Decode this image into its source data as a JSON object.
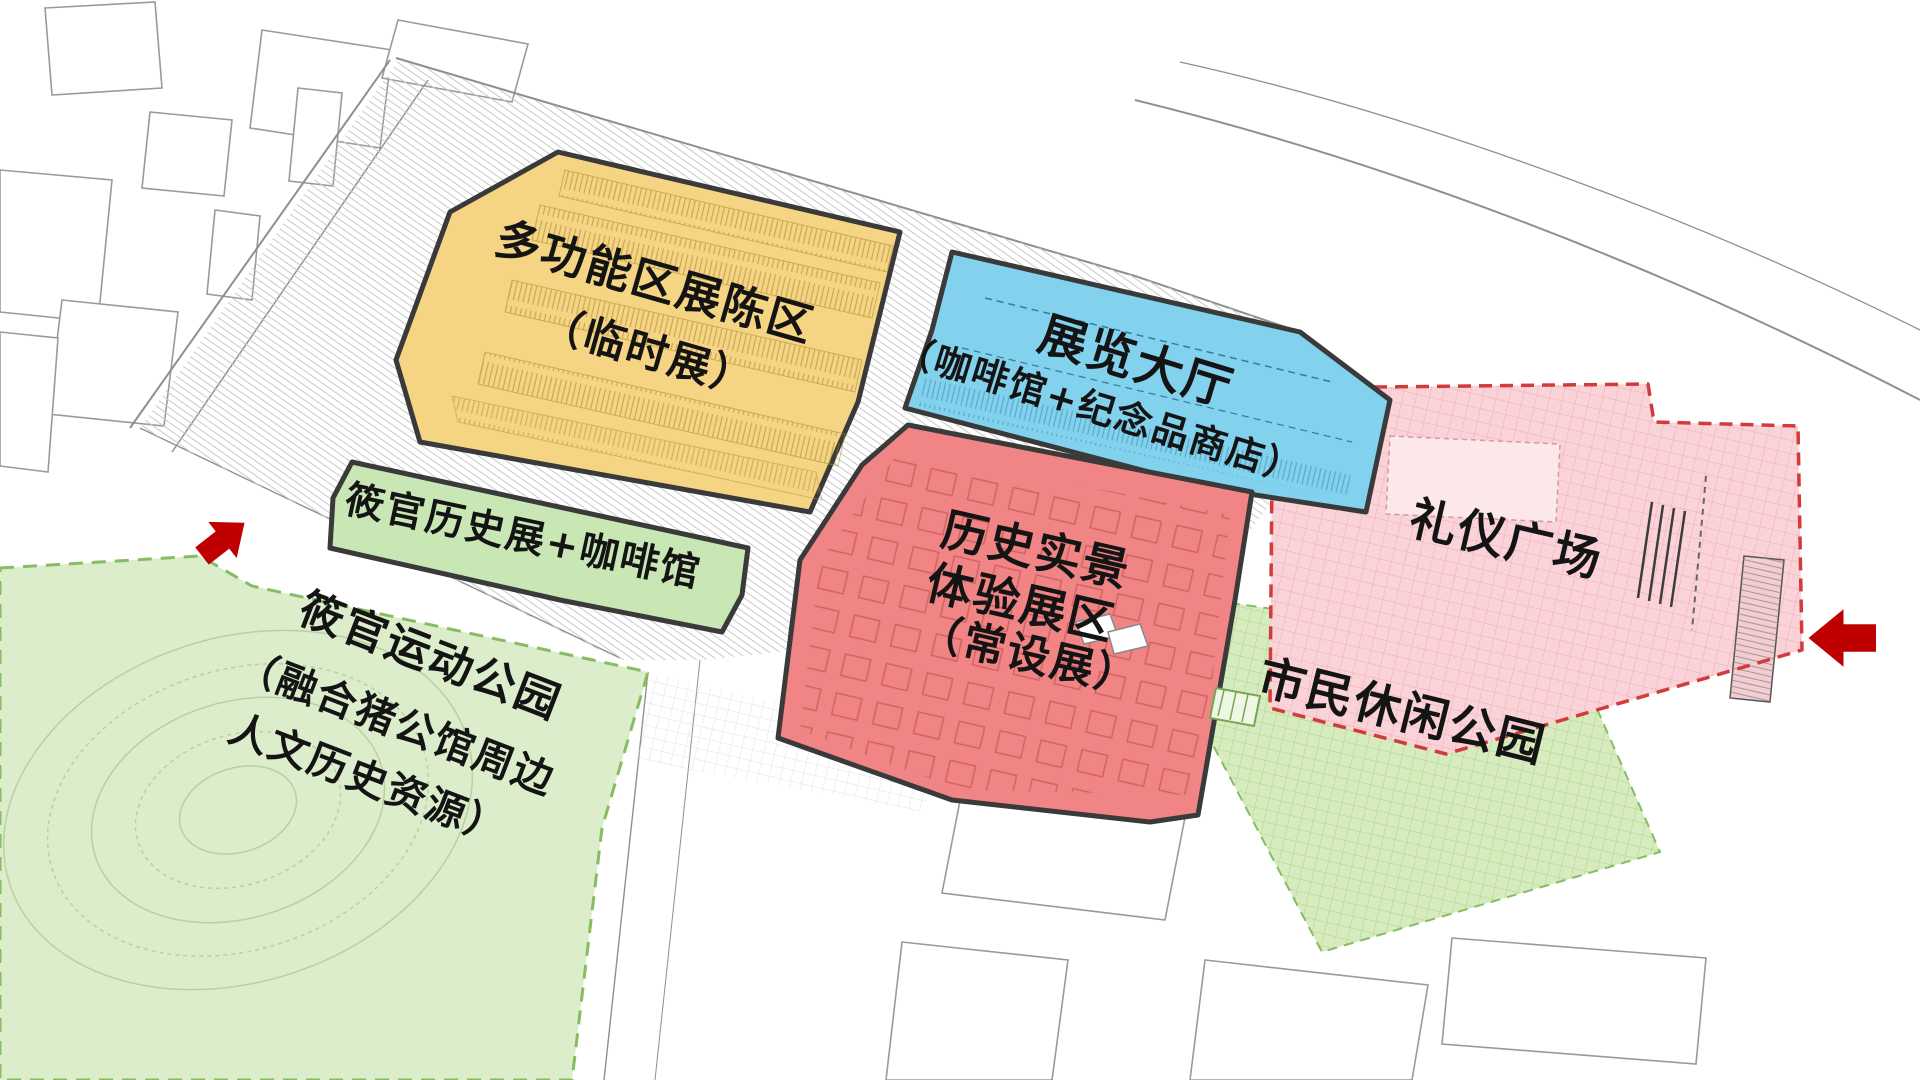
{
  "zones": {
    "temp_exhibition": {
      "line1": "多功能区展陈区",
      "line2": "（临时展）"
    },
    "exhibition_hall": {
      "line1": "展览大厅",
      "line2": "（咖啡馆+纪念品商店）"
    },
    "permanent_exhibition": {
      "line1": "历史实景",
      "line2": "体验展区",
      "line3": "（常设展）"
    },
    "history_cafe_strip": {
      "line1": "筱官历史展+咖啡馆"
    },
    "sports_park": {
      "line1": "筱官运动公园",
      "line2": "（融合猪公馆周边",
      "line3": "人文历史资源）"
    },
    "ceremony_plaza": {
      "line1": "礼仪广场"
    },
    "citizen_park": {
      "line1": "市民休闲公园"
    }
  },
  "icons": {
    "left_entrance": "arrow-up-right",
    "right_entrance": "arrow-left"
  },
  "colors": {
    "temp_exhibition": "#f5d584",
    "exhibition_hall": "#82d2ee",
    "permanent_exhibition": "#f18585",
    "history_cafe_strip": "#c9e7b4",
    "sports_park": "#dcedcb",
    "ceremony_plaza": "#fad3d8",
    "citizen_park": "#d6ecbe",
    "entrance_arrow": "#bf0000",
    "zone_outline": "#3a3a3a"
  }
}
